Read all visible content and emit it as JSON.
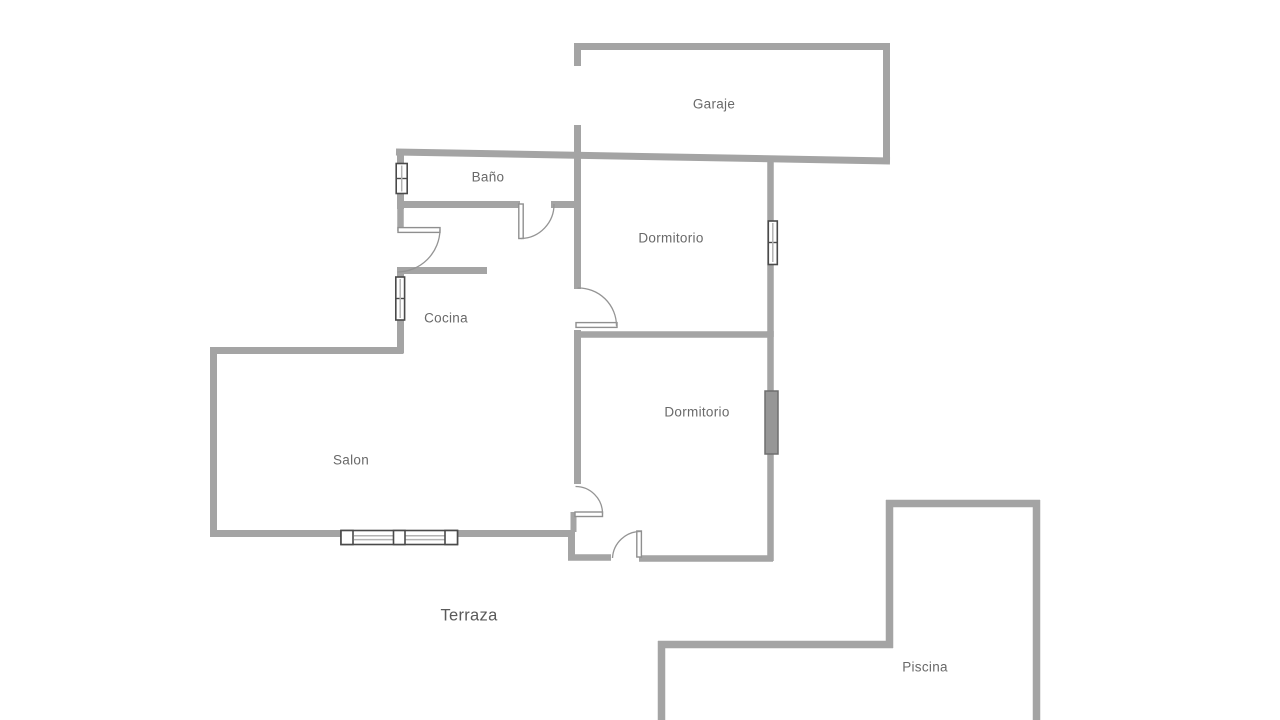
{
  "colors": {
    "wall": "#a4a4a4",
    "door": "#8f8f8f",
    "arc": "#949494",
    "window_frame": "#4a4a4a",
    "window_glass": "#b3b3b3",
    "label": "#696969",
    "label_large": "#5a5a5a",
    "background": "#ffffff"
  },
  "rooms": [
    {
      "id": "garaje",
      "name": "Garaje",
      "x": 714,
      "y": 104
    },
    {
      "id": "bano",
      "name": "Baño",
      "x": 488,
      "y": 177
    },
    {
      "id": "dormitorio-1",
      "name": "Dormitorio",
      "x": 671,
      "y": 238
    },
    {
      "id": "cocina",
      "name": "Cocina",
      "x": 446,
      "y": 318
    },
    {
      "id": "salon",
      "name": "Salon",
      "x": 351,
      "y": 460
    },
    {
      "id": "dormitorio-2",
      "name": "Dormitorio",
      "x": 697,
      "y": 412
    },
    {
      "id": "terraza",
      "name": "Terraza",
      "x": 469,
      "y": 616,
      "size": "large"
    },
    {
      "id": "piscina",
      "name": "Piscina",
      "x": 925,
      "y": 667
    }
  ]
}
